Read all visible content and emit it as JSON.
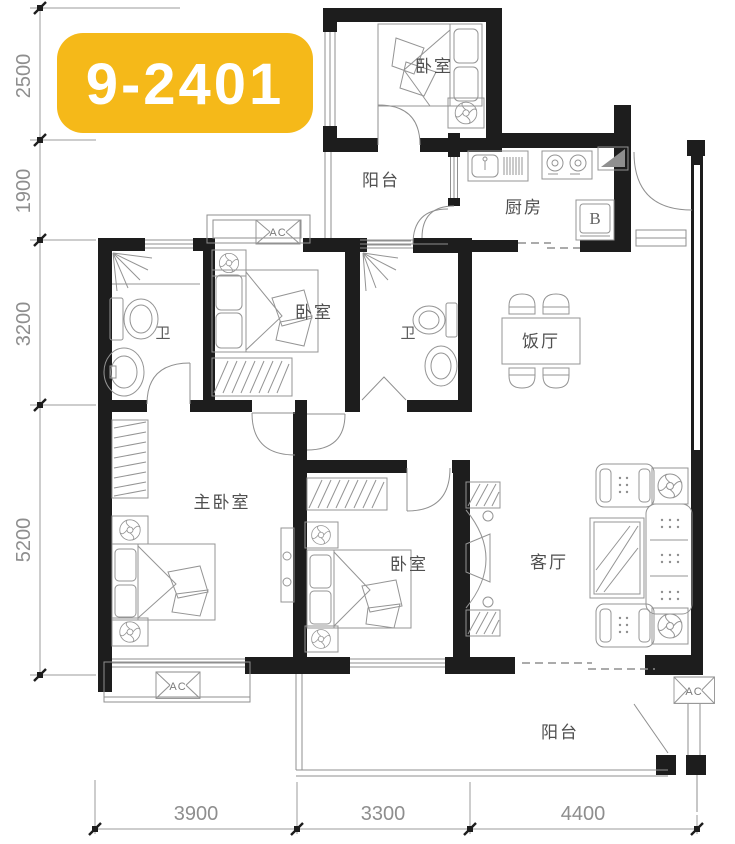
{
  "badge": {
    "unit_number": "9-2401"
  },
  "rooms": {
    "bedroom_top": "卧室",
    "balcony_top": "阳台",
    "kitchen": "厨房",
    "bath_left": "卫",
    "bedroom_middle": "卧室",
    "bath_mid": "卫",
    "dining": "饭厅",
    "master_bedroom": "主卧室",
    "bedroom_bottom": "卧室",
    "living": "客厅",
    "balcony_bottom": "阳台"
  },
  "appliances": {
    "fridge": "B",
    "ac": "AC"
  },
  "dimensions": {
    "left": [
      "2500",
      "1900",
      "3200",
      "5200"
    ],
    "bottom": [
      "3900",
      "3300",
      "4400"
    ]
  },
  "colors": {
    "badge_bg": "#F5B919",
    "badge_text": "#FFFFFF",
    "wall": "#1D1D1D",
    "furniture_line": "#949494",
    "label_text": "#4F4F4F",
    "dimension_text": "#8E8E8E"
  }
}
